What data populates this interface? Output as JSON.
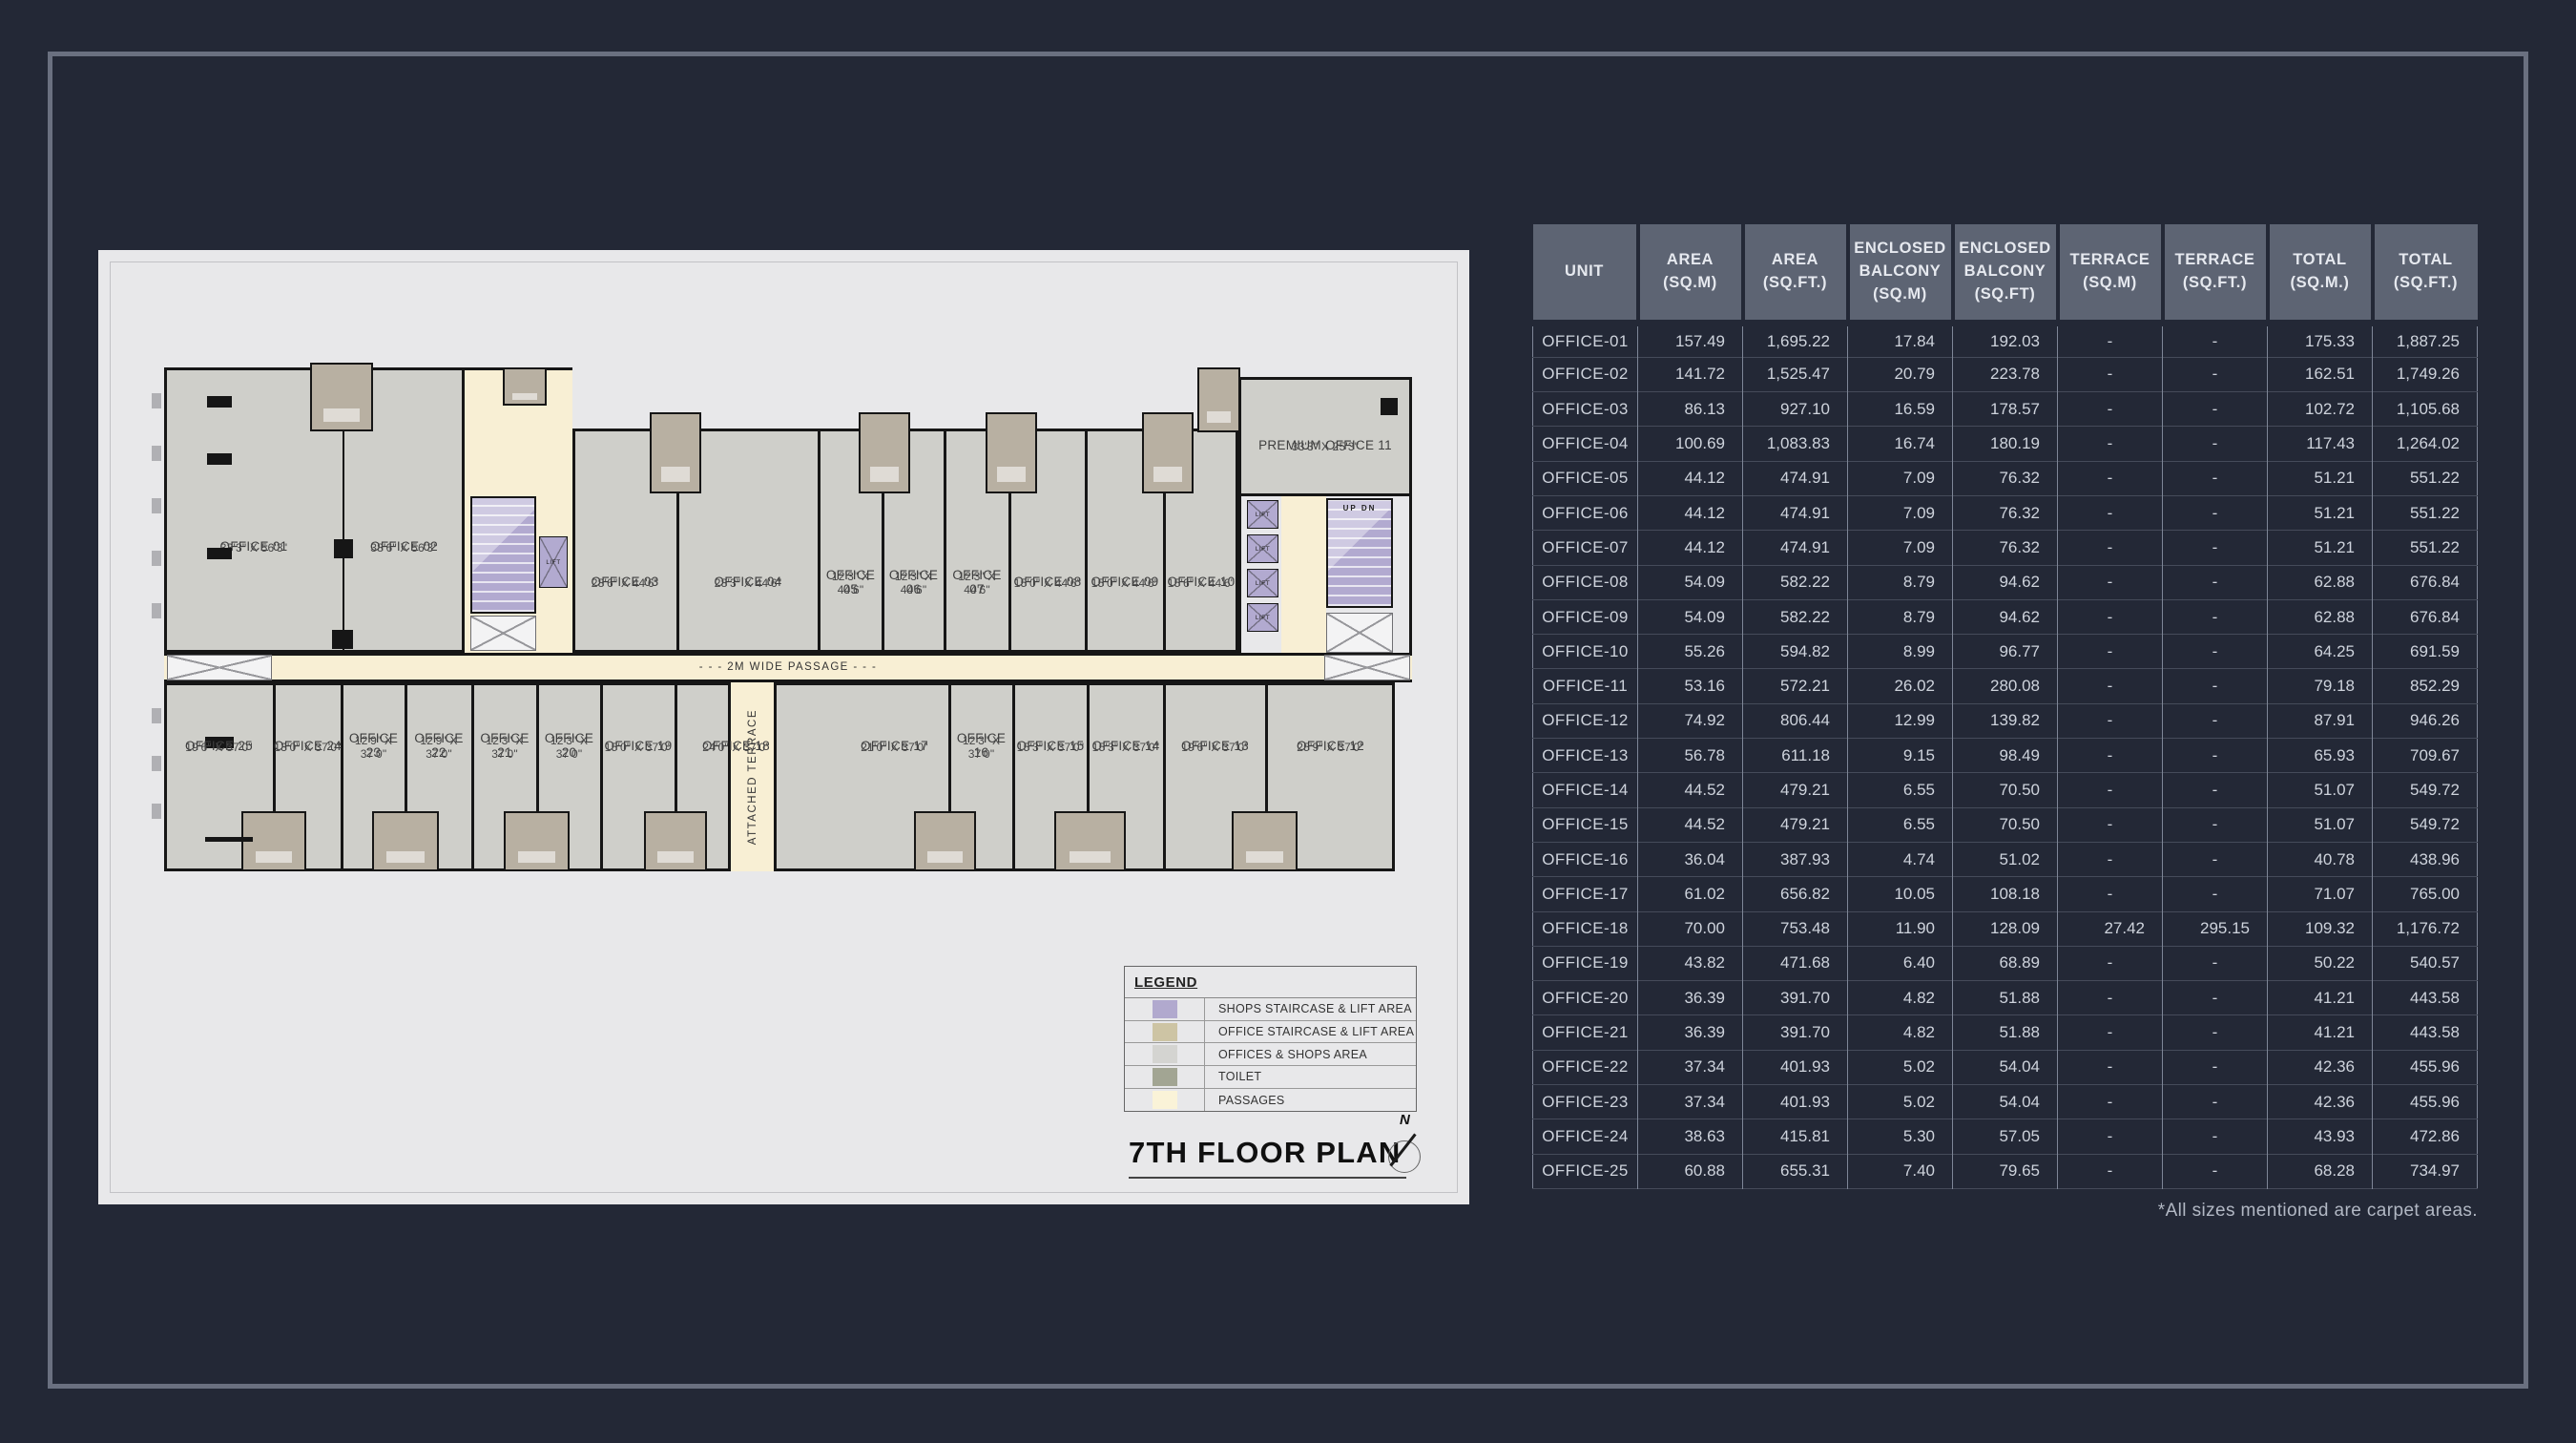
{
  "page": {
    "footnote": "*All sizes mentioned are carpet areas."
  },
  "colors": {
    "page_bg": "#232836",
    "frame_border": "#6a7080",
    "panel_bg": "#e8e8ea",
    "table_header_bg": "#5d6473",
    "wall": "#161616",
    "offices_gray": "#cfcfca",
    "shops_staircase_purple": "#b2aad0",
    "office_staircase_tan": "#cdc4a4",
    "toilet": "#a2a593",
    "passages_cream": "#f8efd4"
  },
  "plan": {
    "title": "7TH FLOOR PLAN",
    "compass_label": "N",
    "passage_label": "- - - 2M WIDE PASSAGE - - -",
    "terrace_label": "ATTACHED TERRACE",
    "lift_label": "LIFT",
    "stair_up_label": "UP",
    "stair_dn_label": "DN",
    "office_01": {
      "name": "OFFICE 01",
      "dims": "33'3\" X 56'3\""
    },
    "office_02": {
      "name": "OFFICE 02",
      "dims": "38'6\" X 56'3\""
    },
    "premium_office": {
      "name": "PREMIUM OFFICE 11",
      "dims": "33'3\" X 25'3\""
    },
    "upper_offices": [
      {
        "name": "OFFICE 03",
        "dims": "28'6\" X 44'6\""
      },
      {
        "name": "OFFICE 04",
        "dims": "28'3\" X 44'6\""
      },
      {
        "name": "OFFICE 05",
        "dims": "12'3\" X 44'6\""
      },
      {
        "name": "OFFICE 06",
        "dims": "12'3\" X 44'6\""
      },
      {
        "name": "OFFICE 07",
        "dims": "12'3\" X 44'6\""
      },
      {
        "name": "OFFICE 08",
        "dims": "15'0\" X 44'6\""
      },
      {
        "name": "OFFICE 09",
        "dims": "15'0\" X 44'6\""
      },
      {
        "name": "OFFICE 10",
        "dims": "15'6\" X 44'6\""
      }
    ],
    "lower_offices": [
      {
        "name": "OFFICE 25",
        "dims": "19'6\" X 37'0\""
      },
      {
        "name": "OFFICE 24",
        "dims": "13'0\" X 37'0\""
      },
      {
        "name": "OFFICE 23",
        "dims": "12'9\" X 37'0\""
      },
      {
        "name": "OFFICE 22",
        "dims": "12'9\" X 37'0\""
      },
      {
        "name": "OFFICE 21",
        "dims": "12'3\" X 37'0\""
      },
      {
        "name": "OFFICE 20",
        "dims": "12'3\" X 37'0\""
      },
      {
        "name": "OFFICE 19",
        "dims": "15'0\" X 37'0\""
      },
      {
        "name": "OFFICE 18",
        "dims": "24'0\" X 37'0\""
      },
      {
        "name": "OFFICE 17",
        "dims": "21'0\" X 37'0\""
      },
      {
        "name": "OFFICE 16",
        "dims": "12'3\" X 37'0\""
      },
      {
        "name": "OFFICE 15",
        "dims": "15'3\" X 37'0\""
      },
      {
        "name": "OFFICE 14",
        "dims": "15'3\" X 37'0\""
      },
      {
        "name": "OFFICE 13",
        "dims": "19'6\" X 37'0\""
      },
      {
        "name": "OFFICE 12",
        "dims": "25'9\" X 37'0\""
      }
    ],
    "legend": {
      "title": "LEGEND",
      "items": [
        {
          "label": "SHOPS STAIRCASE & LIFT AREA",
          "color": "#b1a9ce"
        },
        {
          "label": "OFFICE STAIRCASE & LIFT AREA",
          "color": "#cdc4a4"
        },
        {
          "label": "OFFICES & SHOPS AREA",
          "color": "#d4d4d1"
        },
        {
          "label": "TOILET",
          "color": "#a2a593"
        },
        {
          "label": "PASSAGES",
          "color": "#faf3d8"
        }
      ]
    }
  },
  "table": {
    "columns": [
      [
        "UNIT"
      ],
      [
        "AREA",
        "(SQ.M)"
      ],
      [
        "AREA",
        "(SQ.FT.)"
      ],
      [
        "ENCLOSED",
        "BALCONY",
        "(SQ.M)"
      ],
      [
        "ENCLOSED",
        "BALCONY",
        "(SQ.FT)"
      ],
      [
        "TERRACE",
        "(SQ.M)"
      ],
      [
        "TERRACE",
        "(SQ.FT.)"
      ],
      [
        "TOTAL",
        "(SQ.M.)"
      ],
      [
        "TOTAL",
        "(SQ.FT.)"
      ]
    ],
    "rows": [
      [
        "OFFICE-01",
        "157.49",
        "1,695.22",
        "17.84",
        "192.03",
        "-",
        "-",
        "175.33",
        "1,887.25"
      ],
      [
        "OFFICE-02",
        "141.72",
        "1,525.47",
        "20.79",
        "223.78",
        "-",
        "-",
        "162.51",
        "1,749.26"
      ],
      [
        "OFFICE-03",
        "86.13",
        "927.10",
        "16.59",
        "178.57",
        "-",
        "-",
        "102.72",
        "1,105.68"
      ],
      [
        "OFFICE-04",
        "100.69",
        "1,083.83",
        "16.74",
        "180.19",
        "-",
        "-",
        "117.43",
        "1,264.02"
      ],
      [
        "OFFICE-05",
        "44.12",
        "474.91",
        "7.09",
        "76.32",
        "-",
        "-",
        "51.21",
        "551.22"
      ],
      [
        "OFFICE-06",
        "44.12",
        "474.91",
        "7.09",
        "76.32",
        "-",
        "-",
        "51.21",
        "551.22"
      ],
      [
        "OFFICE-07",
        "44.12",
        "474.91",
        "7.09",
        "76.32",
        "-",
        "-",
        "51.21",
        "551.22"
      ],
      [
        "OFFICE-08",
        "54.09",
        "582.22",
        "8.79",
        "94.62",
        "-",
        "-",
        "62.88",
        "676.84"
      ],
      [
        "OFFICE-09",
        "54.09",
        "582.22",
        "8.79",
        "94.62",
        "-",
        "-",
        "62.88",
        "676.84"
      ],
      [
        "OFFICE-10",
        "55.26",
        "594.82",
        "8.99",
        "96.77",
        "-",
        "-",
        "64.25",
        "691.59"
      ],
      [
        "OFFICE-11",
        "53.16",
        "572.21",
        "26.02",
        "280.08",
        "-",
        "-",
        "79.18",
        "852.29"
      ],
      [
        "OFFICE-12",
        "74.92",
        "806.44",
        "12.99",
        "139.82",
        "-",
        "-",
        "87.91",
        "946.26"
      ],
      [
        "OFFICE-13",
        "56.78",
        "611.18",
        "9.15",
        "98.49",
        "-",
        "-",
        "65.93",
        "709.67"
      ],
      [
        "OFFICE-14",
        "44.52",
        "479.21",
        "6.55",
        "70.50",
        "-",
        "-",
        "51.07",
        "549.72"
      ],
      [
        "OFFICE-15",
        "44.52",
        "479.21",
        "6.55",
        "70.50",
        "-",
        "-",
        "51.07",
        "549.72"
      ],
      [
        "OFFICE-16",
        "36.04",
        "387.93",
        "4.74",
        "51.02",
        "-",
        "-",
        "40.78",
        "438.96"
      ],
      [
        "OFFICE-17",
        "61.02",
        "656.82",
        "10.05",
        "108.18",
        "-",
        "-",
        "71.07",
        "765.00"
      ],
      [
        "OFFICE-18",
        "70.00",
        "753.48",
        "11.90",
        "128.09",
        "27.42",
        "295.15",
        "109.32",
        "1,176.72"
      ],
      [
        "OFFICE-19",
        "43.82",
        "471.68",
        "6.40",
        "68.89",
        "-",
        "-",
        "50.22",
        "540.57"
      ],
      [
        "OFFICE-20",
        "36.39",
        "391.70",
        "4.82",
        "51.88",
        "-",
        "-",
        "41.21",
        "443.58"
      ],
      [
        "OFFICE-21",
        "36.39",
        "391.70",
        "4.82",
        "51.88",
        "-",
        "-",
        "41.21",
        "443.58"
      ],
      [
        "OFFICE-22",
        "37.34",
        "401.93",
        "5.02",
        "54.04",
        "-",
        "-",
        "42.36",
        "455.96"
      ],
      [
        "OFFICE-23",
        "37.34",
        "401.93",
        "5.02",
        "54.04",
        "-",
        "-",
        "42.36",
        "455.96"
      ],
      [
        "OFFICE-24",
        "38.63",
        "415.81",
        "5.30",
        "57.05",
        "-",
        "-",
        "43.93",
        "472.86"
      ],
      [
        "OFFICE-25",
        "60.88",
        "655.31",
        "7.40",
        "79.65",
        "-",
        "-",
        "68.28",
        "734.97"
      ]
    ]
  }
}
